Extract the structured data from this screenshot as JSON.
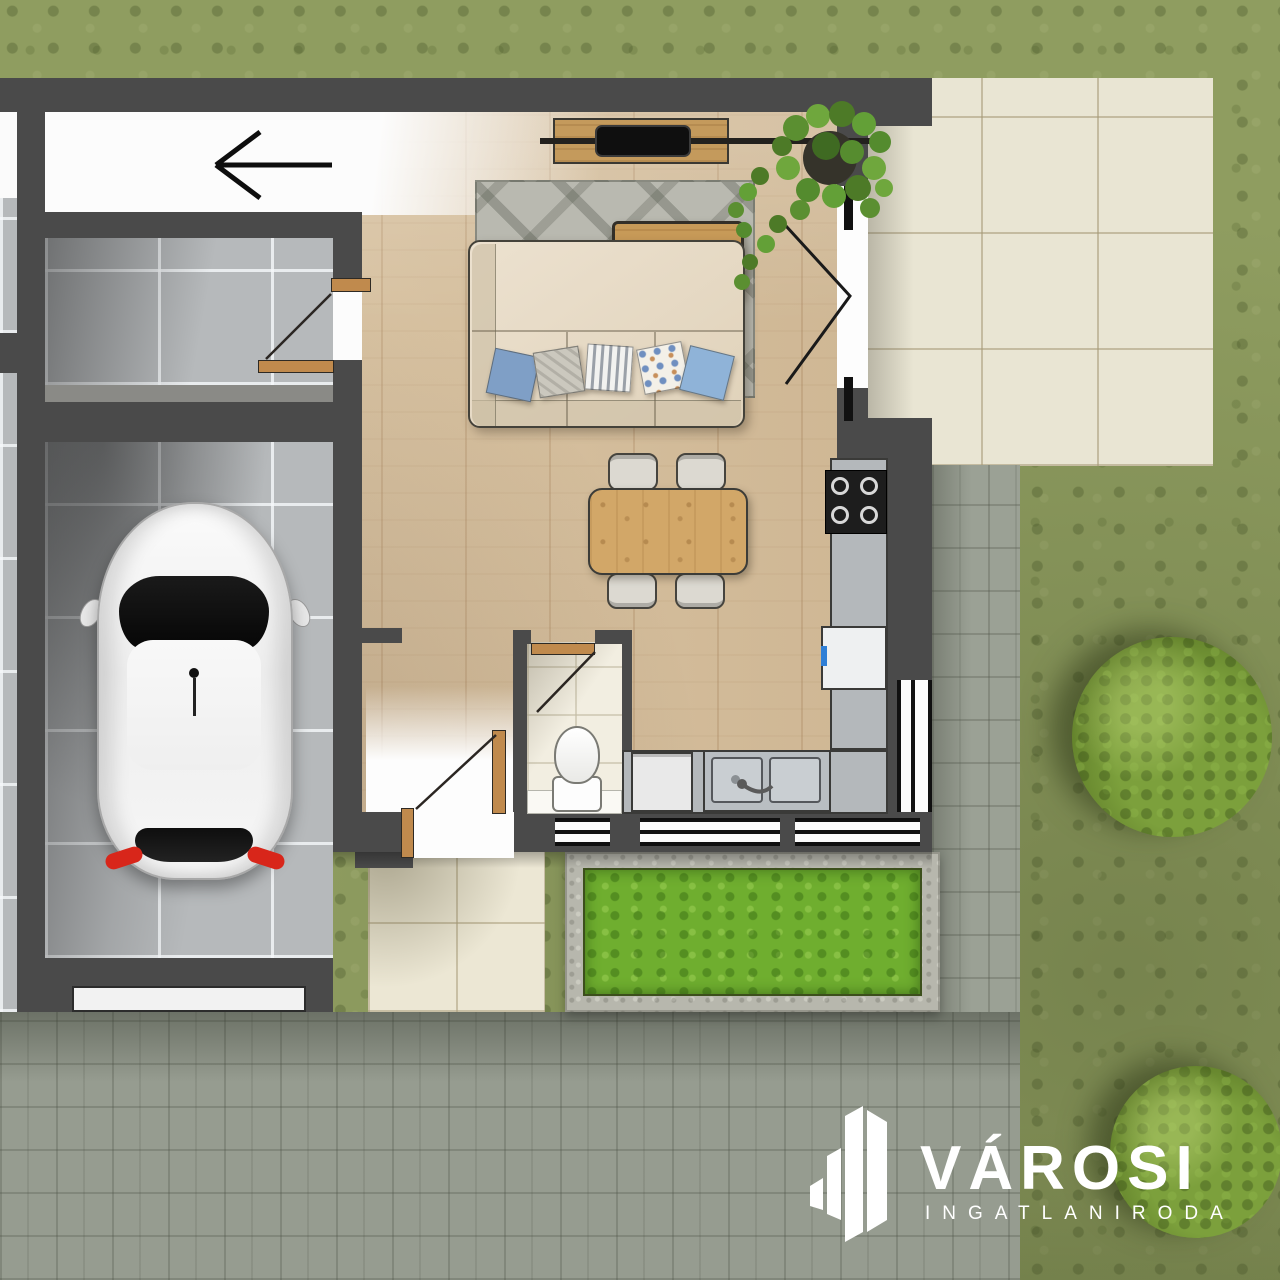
{
  "logo": {
    "brand": "VÁROSI",
    "tagline": "INGATLANIRODA"
  },
  "icons": {
    "entry_arrow": "arrow-left",
    "logo_mark": "building-skyline"
  },
  "palette": {
    "wall": "#4a4a4a",
    "lawn_grass": "#8f9d60",
    "planter_grass": "#6fae2f",
    "paver": "#9ba195",
    "patio_tile": "#e9e5d3",
    "walkway_tile": "#ece7d4",
    "wood_floor": "#d8c2a0",
    "garage_tile": "#b6b9bb",
    "rug": "#b9b9b0",
    "sofa": "#e7dbc7",
    "dining_wood": "#d2a768",
    "coffee_table_wood": "#c79a58",
    "kitchen_counter": "#b4b8bb",
    "cooktop": "#1d1d1d",
    "car_body": "#f3f3f3",
    "taillight_red": "#d8261a",
    "pillow_blue": "#7f9fc6",
    "logo_white": "#ffffff"
  }
}
